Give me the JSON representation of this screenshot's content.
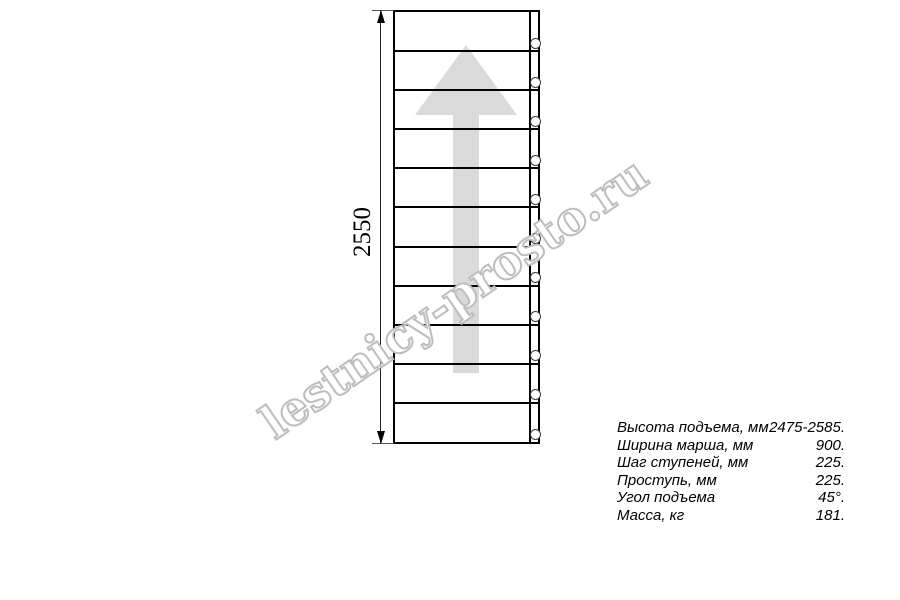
{
  "drawing": {
    "dimension_label": "2550",
    "step_count": 11,
    "arrow_icon": "up-direction-arrow",
    "colors": {
      "line": "#000000",
      "dimension_line": "#333333",
      "arrow_fill": "#dadada",
      "watermark_stroke": "#bdbdbd"
    }
  },
  "specs": {
    "rows": [
      {
        "label": "Высота подъема, мм",
        "value": "2475-2585."
      },
      {
        "label": "Ширина марша, мм",
        "value": "900."
      },
      {
        "label": "Шаг ступеней, мм",
        "value": "225."
      },
      {
        "label": "Проступь, мм",
        "value": "225."
      },
      {
        "label": "Угол подъема",
        "value": "45°."
      },
      {
        "label": "Масса, кг",
        "value": "181."
      }
    ]
  },
  "watermark": {
    "text": "lestnicy-prosto.ru"
  }
}
